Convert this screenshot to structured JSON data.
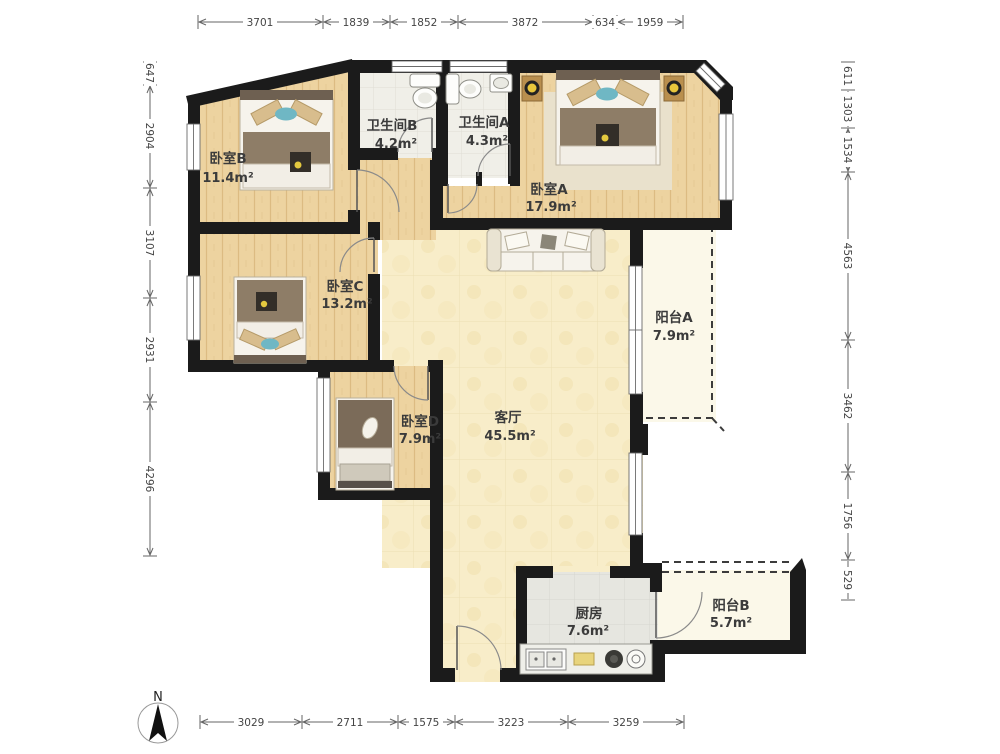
{
  "compass": {
    "north_label": "N"
  },
  "rooms": [
    {
      "id": "bedroom-b",
      "name": "卧室B",
      "area": "11.4m²"
    },
    {
      "id": "bathroom-b",
      "name": "卫生间B",
      "area": "4.2m²"
    },
    {
      "id": "bathroom-a",
      "name": "卫生间A",
      "area": "4.3m²"
    },
    {
      "id": "bedroom-a",
      "name": "卧室A",
      "area": "17.9m²"
    },
    {
      "id": "bedroom-c",
      "name": "卧室C",
      "area": "13.2m²"
    },
    {
      "id": "bedroom-d",
      "name": "卧室D",
      "area": "7.9m²"
    },
    {
      "id": "living-room",
      "name": "客厅",
      "area": "45.5m²"
    },
    {
      "id": "balcony-a",
      "name": "阳台A",
      "area": "7.9m²"
    },
    {
      "id": "kitchen",
      "name": "厨房",
      "area": "7.6m²"
    },
    {
      "id": "balcony-b",
      "name": "阳台B",
      "area": "5.7m²"
    }
  ],
  "dimensions": {
    "top": [
      "3701",
      "1839",
      "1852",
      "3872",
      "634",
      "1959"
    ],
    "bottom": [
      "3029",
      "2711",
      "1575",
      "3223",
      "3259"
    ],
    "left": [
      "647",
      "2904",
      "3107",
      "2931",
      "4296"
    ],
    "right": [
      "611",
      "1303",
      "1534",
      "4563",
      "3462",
      "1756",
      "529"
    ]
  }
}
